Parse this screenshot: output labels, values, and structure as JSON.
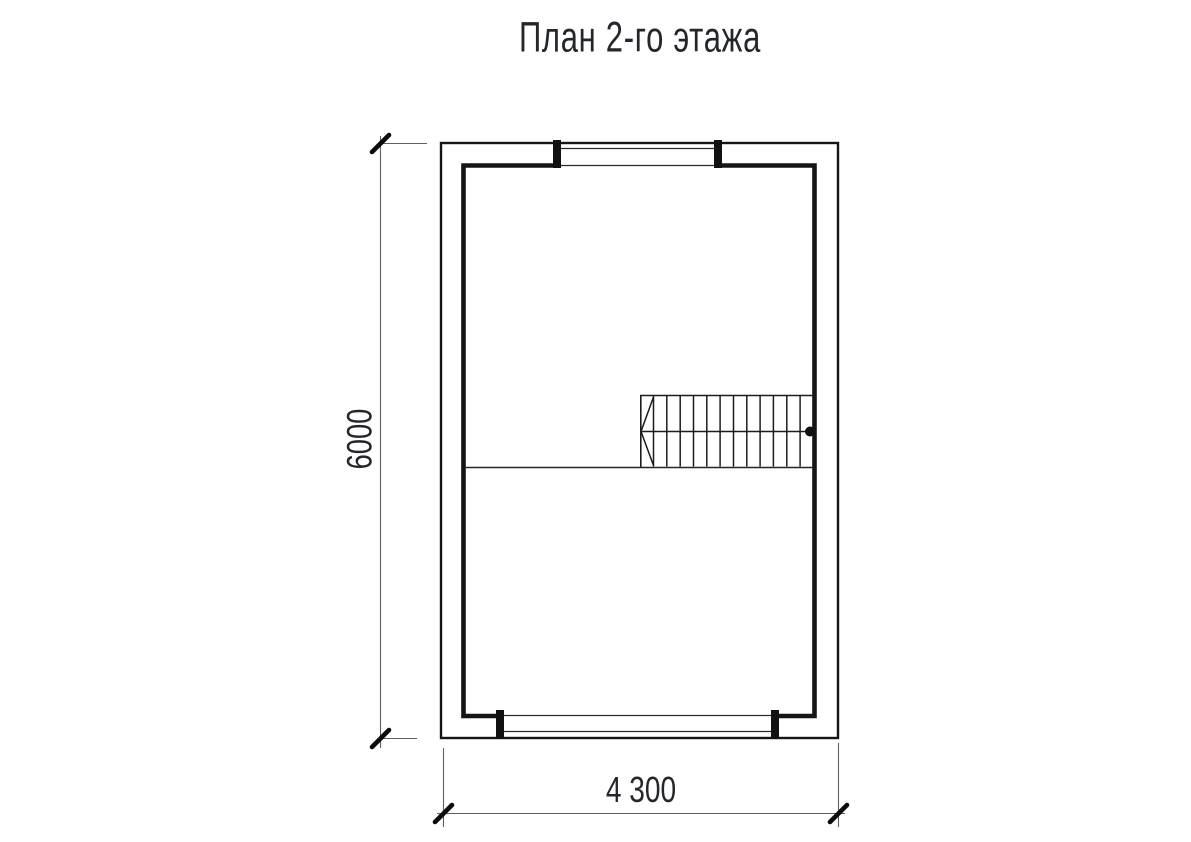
{
  "title": "План 2-го этажа",
  "floor_plan": {
    "kind": "second-floor-plan-drawing",
    "dimension_height": {
      "label": "6000",
      "orientation": "vertical-left"
    },
    "dimension_width": {
      "label": "4 300",
      "orientation": "horizontal-bottom"
    },
    "elements": [
      "outer-wall-outline",
      "inner-wall-outline",
      "window-top",
      "window-bottom",
      "stairs",
      "stair-direction-line",
      "floor-divider-line"
    ],
    "colors": {
      "wall_line": "#151515",
      "thin_line": "#2a2a2a",
      "dimension_line": "#606060",
      "tick_mark": "#0c0c0c",
      "text": "#23262b",
      "background": "#ffffff"
    }
  }
}
